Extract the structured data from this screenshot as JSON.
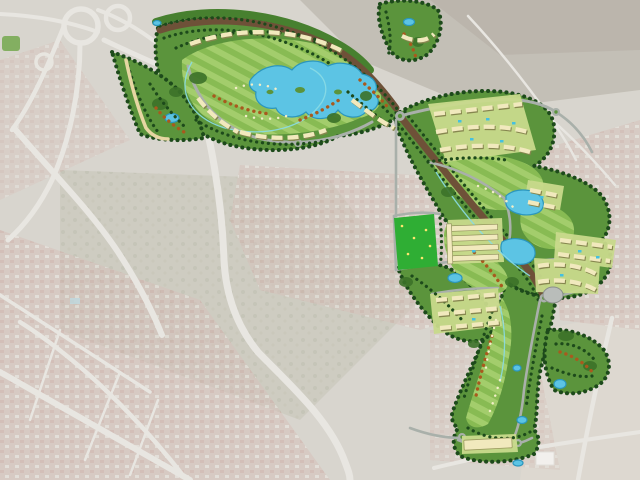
{
  "map": {
    "kind": "aerial-photo-with-masterplan-overlay",
    "description": "faded satellite photo of a city with a saturated golf-resort master plan drawn over it, running diagonally from the upper-left to the lower-right",
    "legend": [
      {
        "feature": "golf-fairway",
        "color": "#9fca67"
      },
      {
        "feature": "golf-rough",
        "color": "#5b943c"
      },
      {
        "feature": "tree-belt",
        "color": "#1d4a1b"
      },
      {
        "feature": "dense-canopy",
        "color": "#3c7229"
      },
      {
        "feature": "lake-pond",
        "color": "#5cc4e4"
      },
      {
        "feature": "residential-row",
        "color": "#f1e9bd"
      },
      {
        "feature": "cluster-lawn",
        "color": "#c9da8c"
      },
      {
        "feature": "tree-lined-avenue",
        "color": "#6e5138"
      },
      {
        "feature": "green-buffer-strip",
        "color": "#47802f"
      },
      {
        "feature": "plan-road",
        "color": "#a9b0aa"
      },
      {
        "feature": "sports-field",
        "color": "#2fae34"
      },
      {
        "feature": "autumn-shrubs",
        "color": "#a85a1e"
      },
      {
        "feature": "sand-bunker",
        "color": "#f2eec8"
      },
      {
        "feature": "cart-path",
        "color": "#8adbe4"
      },
      {
        "feature": "walking-path",
        "color": "#e6d6a2"
      },
      {
        "feature": "existing-city-faded",
        "color": "#c8c3b9"
      }
    ]
  },
  "colors": {
    "bgBase": "#c8c3b9",
    "bgWash": "#ffffff",
    "hillPatch": "#a39c8e",
    "scrubPatch": "#b1af9e",
    "urbanBase": "#c4a79d",
    "urbanRoof": "#b98b80",
    "urbanLight": "#e3ded6",
    "bgRoad": "#dedbd4",
    "roughGreen": "#5b943c",
    "fairwayLight": "#a3cd6c",
    "fairwayMid": "#88bb53",
    "treeDark": "#1d4a1b",
    "oliveTree": "#3c7229",
    "lakeFill": "#5cc4e4",
    "lakeEdge": "#2b96bd",
    "poolBlue": "#45c0e0",
    "corridorBrown": "#6e5138",
    "stripGreen": "#47802f",
    "roadGray": "#a9b0aa",
    "bldgCream": "#f1e9bd",
    "bldgShadow": "#86864f",
    "clusterLawn": "#c9da8c",
    "fieldGreen": "#2fae34",
    "speckYellow": "#ffe66e",
    "shrubOrange": "#a85a1e",
    "bunkerCream": "#f2eec8",
    "cartPathCyan": "#8adbe4",
    "beigePath": "#e6d6a2",
    "grayBuilding": "#b9bdba",
    "whiteBuilding": "#eceae6"
  }
}
